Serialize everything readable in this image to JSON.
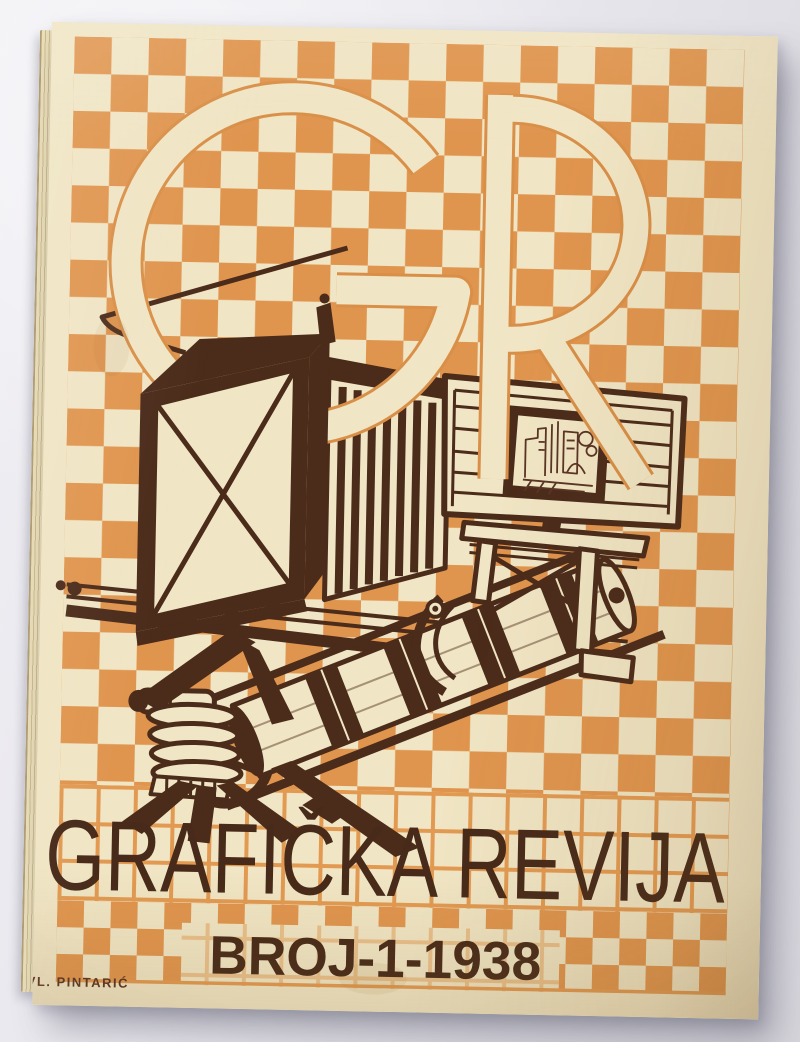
{
  "cover": {
    "monogram": {
      "letters": [
        "G",
        "R"
      ],
      "label": "GR"
    },
    "title": "GRAFIČKA REVIJA",
    "issue": "BROJ-1-1938",
    "signature": "VL. PINTARIĆ",
    "illustration": "process-camera-printing-press-illustration",
    "colors": {
      "paper": "#f0e5c4",
      "checker": "#e0954e",
      "grid": "#e29a52",
      "outline": "#d98f47",
      "ink": "#4b2b1a",
      "ink_soft": "#5a3424",
      "title_ink": "#472a19"
    }
  }
}
